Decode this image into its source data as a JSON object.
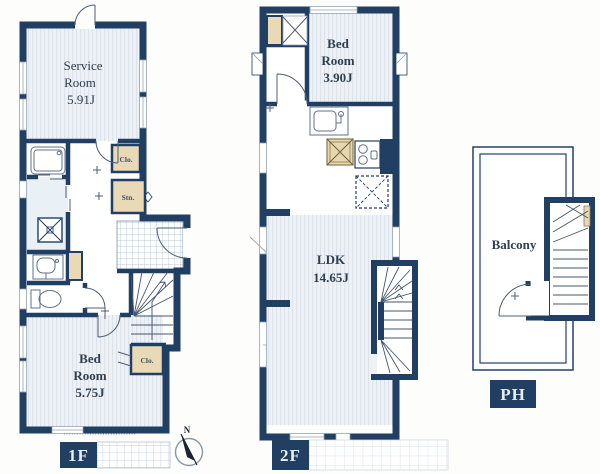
{
  "floors": {
    "f1": {
      "label": "1F",
      "rooms": {
        "service_room": {
          "line1": "Service",
          "line2": "Room",
          "area": "5.91J"
        },
        "bed_room": {
          "line1": "Bed",
          "line2": "Room",
          "area": "5.75J"
        },
        "closet_upper": {
          "label": "Clo."
        },
        "storage": {
          "label": "Stn."
        },
        "closet_lower": {
          "label": "Clo."
        }
      }
    },
    "f2": {
      "label": "2F",
      "rooms": {
        "bed_room": {
          "line1": "Bed",
          "line2": "Room",
          "area": "3.90J"
        },
        "ldk": {
          "line1": "LDK",
          "area": "14.65J"
        }
      }
    },
    "ph": {
      "label": "PH",
      "rooms": {
        "balcony": {
          "label": "Balcony"
        }
      }
    }
  },
  "compass": {
    "north": "N"
  },
  "icons": {
    "compass": "compass-north-needle",
    "fixtures": [
      "bathtub-icon",
      "washing-machine-icon",
      "washbasin-icon",
      "toilet-icon",
      "kitchen-sink-icon",
      "stove-icon",
      "refrigerator-icon",
      "floor-hatch-icon"
    ]
  },
  "colors": {
    "wall_navy": "#213e63",
    "label_box_bg": "#213e63",
    "label_text": "#e8edf4",
    "closet_beige": "#ead9b6",
    "room_stripe_bg": "#eef1f5",
    "room_stripe_line": "#dde3eb",
    "washroom_tint": "#e9f1f6",
    "text_dark": "#2f3e50"
  }
}
